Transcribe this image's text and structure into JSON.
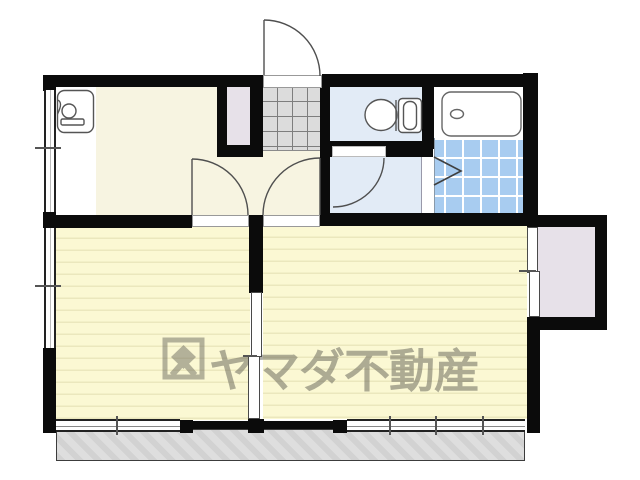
{
  "watermark": {
    "brand": "ヤマダ不動産",
    "logo_icon": "yamada-diamond-logo-icon"
  },
  "colors": {
    "wall": "#0b0b0b",
    "floor_hall": "#f7f4e1",
    "floor_room": "#fbf8d3",
    "room_stripe": "#ebe7bd",
    "floor_wet": "#e2ebf6",
    "tile_bath": "#a8ccf0",
    "tile_grid": "#ffffff",
    "genkan": "#dcdcdc",
    "genkan_grid": "#7e7e7e",
    "closet": "#e7e1e9",
    "balcony": "#d2d2d2",
    "balcony_stripe": "#dedede",
    "outline": "#555555",
    "watermark": "#6e6d60"
  },
  "plan": {
    "fixture_icons": [
      "kitchen-sink-icon",
      "toilet-icon",
      "bathtub-icon",
      "folding-door-icon",
      "entrance-door-swing-icon",
      "room-door-swing-icon",
      "washroom-door-swing-icon"
    ],
    "features": [
      "kitchen",
      "entrance-genkan",
      "hallway",
      "toilet-room",
      "washroom",
      "bathroom",
      "living-room-left",
      "living-room-right",
      "kitchen-closet",
      "right-closet",
      "sliding-partition",
      "balcony"
    ]
  }
}
